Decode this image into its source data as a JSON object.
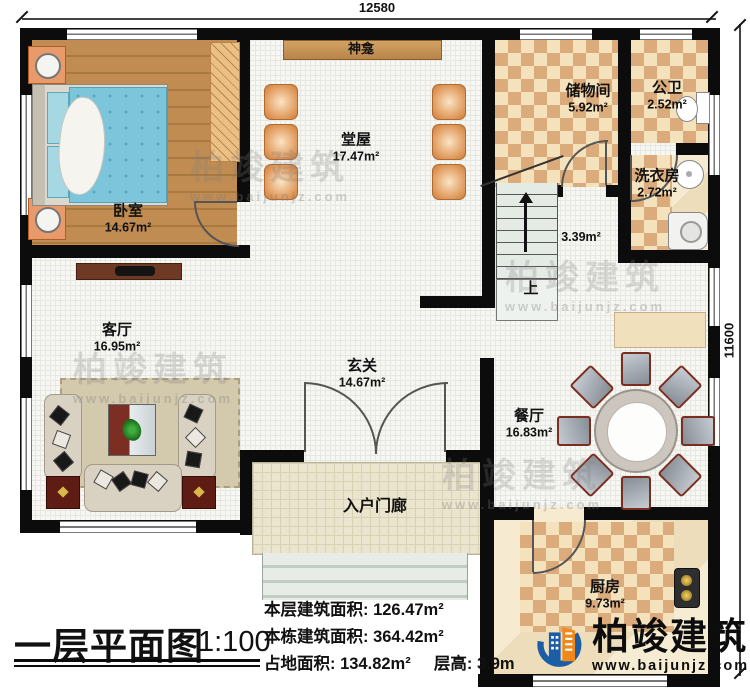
{
  "dimensions": {
    "width_top": "12580",
    "height_right": "11600"
  },
  "rooms": {
    "bedroom": {
      "name": "卧室",
      "area": "14.67m²"
    },
    "hall": {
      "name": "堂屋",
      "area": "17.47m²"
    },
    "shrine": {
      "name": "神龛"
    },
    "storage": {
      "name": "储物间",
      "area": "5.92m²"
    },
    "bathroom": {
      "name": "公卫",
      "area": "2.52m²"
    },
    "laundry": {
      "name": "洗衣房",
      "area": "2.72m²"
    },
    "stair_hall": {
      "area": "3.39m²",
      "up": "上"
    },
    "living": {
      "name": "客厅",
      "area": "16.95m²"
    },
    "foyer": {
      "name": "玄关",
      "area": "14.67m²"
    },
    "dining": {
      "name": "餐厅",
      "area": "16.83m²"
    },
    "kitchen": {
      "name": "厨房",
      "area": "9.73m²"
    },
    "porch": {
      "name": "入户门廊"
    }
  },
  "footer": {
    "title": "一层平面图",
    "scale": "1:100",
    "stats": [
      "本层建筑面积: 126.47m²",
      "本栋建筑面积: 364.42m²",
      "占地面积: 134.82m²",
      "层高: 3.9m"
    ]
  },
  "brand": {
    "name": "柏竣建筑",
    "site": "www.baijunjz.com"
  },
  "watermark": {
    "name": "柏竣建筑",
    "site": "www.baijunjz.com"
  }
}
